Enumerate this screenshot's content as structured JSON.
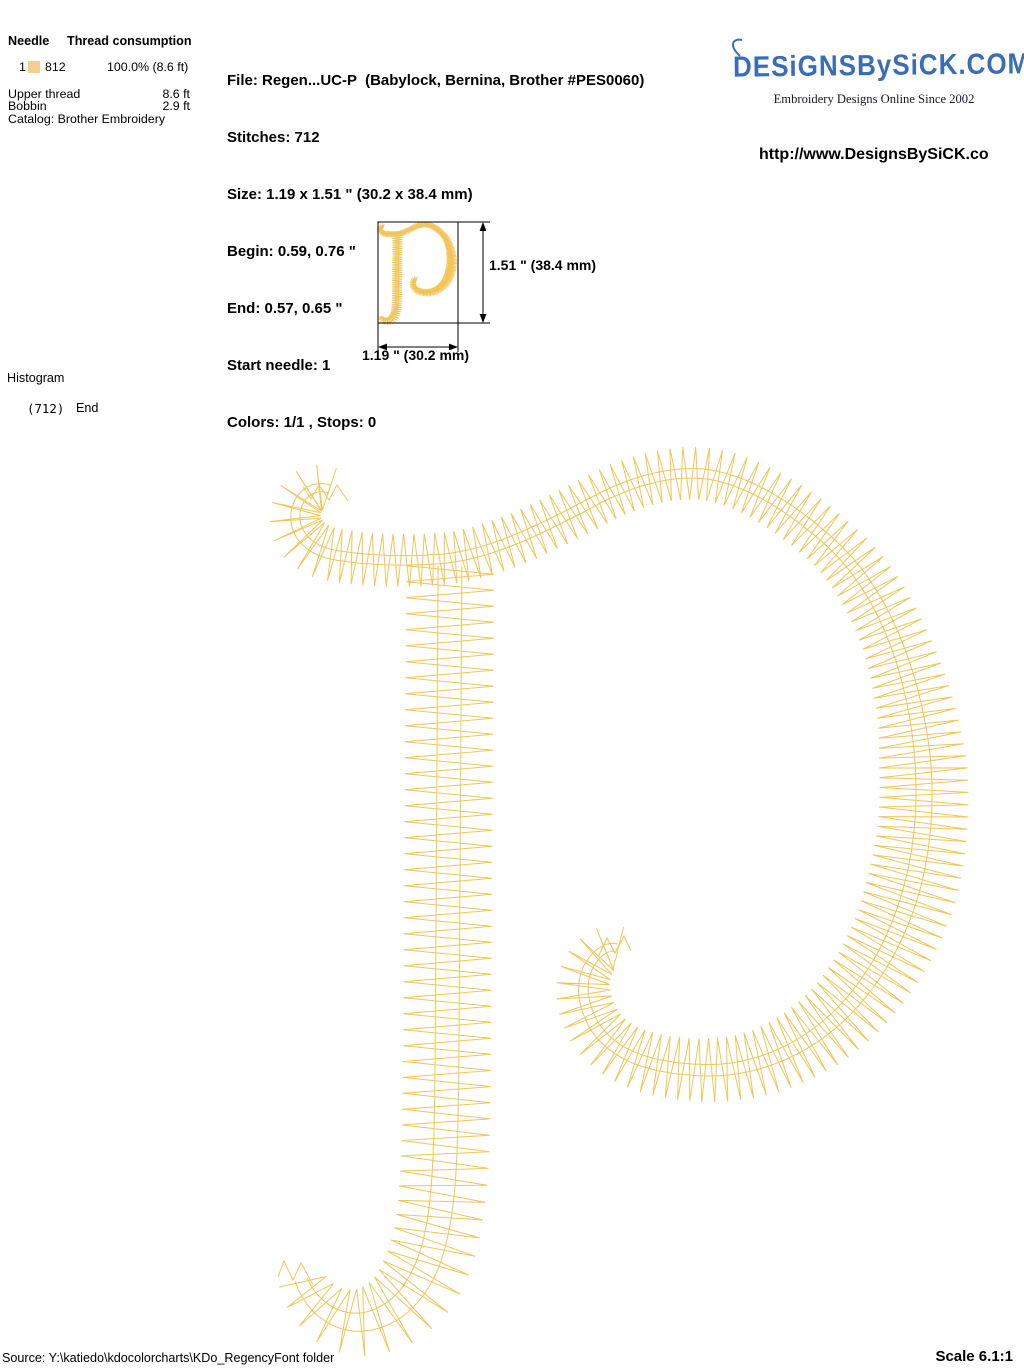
{
  "thread_table": {
    "header_needle": "Needle",
    "header_consumption": "Thread consumption",
    "rows": [
      {
        "needle": "1",
        "color_code": "812",
        "swatch_color": "#F4CE8C",
        "consumption": "100.0% (8.6 ft)"
      }
    ],
    "upper_thread_label": "Upper thread",
    "upper_thread_value": "8.6 ft",
    "bobbin_label": "Bobbin",
    "bobbin_value": "2.9 ft",
    "catalog": "Catalog: Brother Embroidery"
  },
  "file_info": {
    "lines": [
      "File: Regen...UC-P  (Babylock, Bernina, Brother #PES0060)",
      "Stitches: 712",
      "Size: 1.19 x 1.51 \" (30.2 x 38.4 mm)",
      "Begin: 0.59, 0.76 \"",
      "End: 0.57, 0.65 \"",
      "Start needle: 1",
      "Colors: 1/1 , Stops: 0"
    ]
  },
  "branding": {
    "logo_text": "DESiGNSBySiCK.COM",
    "logo_color": "#3A6DB6",
    "tagline": "Embroidery Designs Online Since 2002",
    "url": "http://www.DesignsBySiCK.co"
  },
  "dimensions": {
    "height_label": "1.51 \" (38.4 mm)",
    "width_label": "1.19 \" (30.2 mm)"
  },
  "histogram": {
    "title": "Histogram",
    "stitch_count": "(712)",
    "end_label": "End"
  },
  "design": {
    "letter": "p",
    "thread_color": "#F1C558"
  },
  "footer": {
    "source": "Source: Y:\\katiedo\\kdocolorcharts\\KDo_RegencyFont folder",
    "scale": "Scale 6.1:1"
  }
}
